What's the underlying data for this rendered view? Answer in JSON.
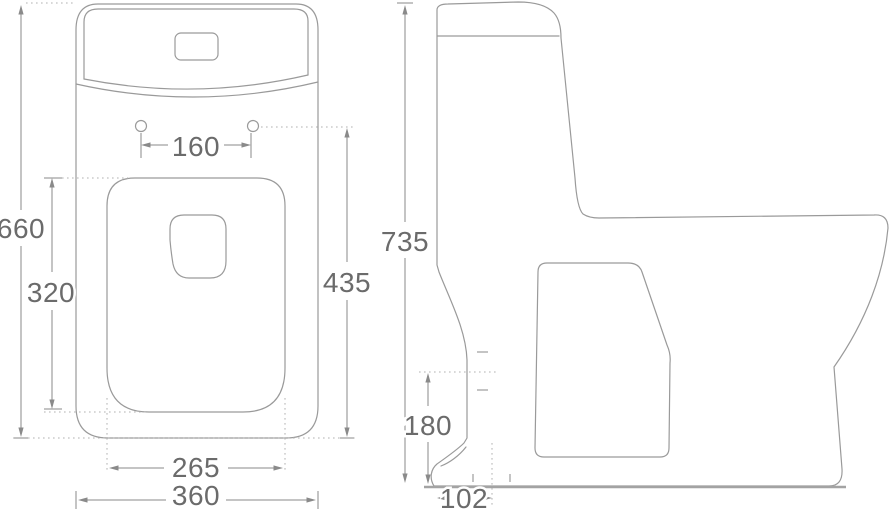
{
  "dimensions": {
    "front": {
      "overall_height": "660",
      "bowl_section_height": "320",
      "seat_bolt_spacing": "160",
      "upper_reference_height": "435",
      "base_inner_width": "265",
      "overall_width": "360"
    },
    "side": {
      "overall_height": "735",
      "trap_height": "180",
      "outlet_offset": "102"
    }
  }
}
